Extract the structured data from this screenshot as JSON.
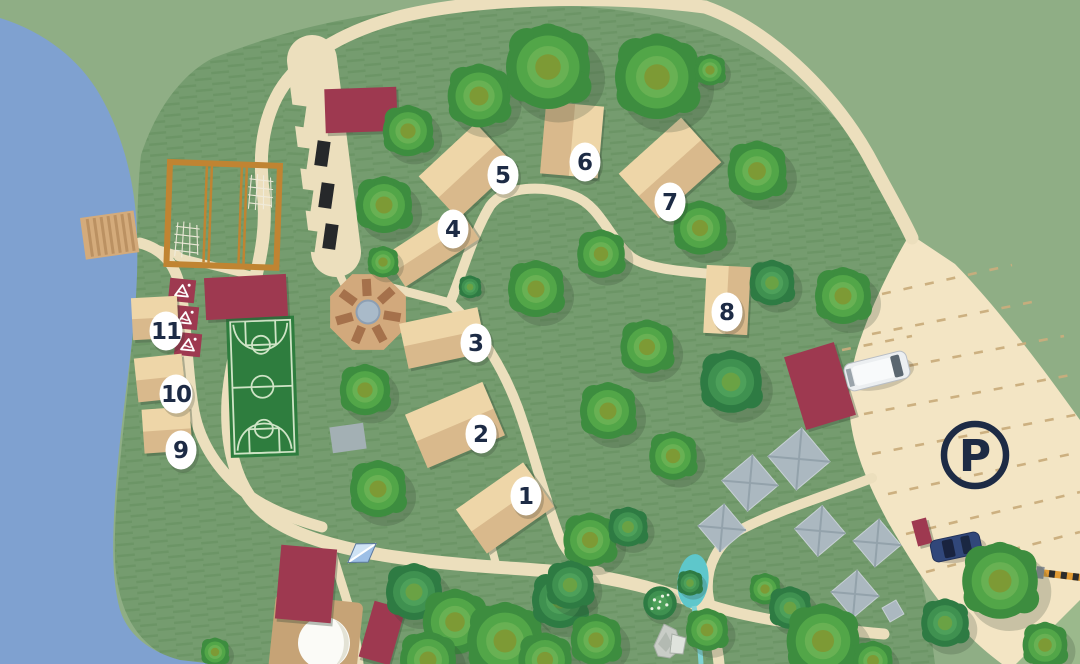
{
  "markers": [
    {
      "id": "1",
      "label": "1"
    },
    {
      "id": "2",
      "label": "2"
    },
    {
      "id": "3",
      "label": "3"
    },
    {
      "id": "4",
      "label": "4"
    },
    {
      "id": "5",
      "label": "5"
    },
    {
      "id": "6",
      "label": "6"
    },
    {
      "id": "7",
      "label": "7"
    },
    {
      "id": "8",
      "label": "8"
    },
    {
      "id": "9",
      "label": "9"
    },
    {
      "id": "10",
      "label": "10"
    },
    {
      "id": "11",
      "label": "11"
    }
  ],
  "parking": {
    "label": "P"
  },
  "colors": {
    "lake": "#7fa1d0",
    "grass_outer": "#8fae85",
    "grass_inner": "#759c6f",
    "grass_stripe": "#64905f",
    "path": "#ecdfbd",
    "parking_lot": "#f3e5c4",
    "parking_dash": "#c9ad7c",
    "cabin_light": "#eed6a8",
    "cabin_dark": "#d9b98c",
    "building_red": "#9e3950",
    "court_green": "#2e7d3e",
    "court_line": "#cfe4c6",
    "frame_orange": "#c08432",
    "navy": "#1d2b45",
    "water": "#5ec7cb",
    "tree_edge": "#3d8d3f",
    "tree_mid": "#52a648",
    "tree_inner": "#68b153",
    "tree_core": "#7d9a35",
    "tent_gray": "#abb8c0",
    "bench_brown": "#a5714b",
    "plaza_tan": "#d2a97c",
    "dock_tan": "#d4ab7b",
    "deck_tan": "#c6a376",
    "marker_bg": "#ffffff"
  }
}
